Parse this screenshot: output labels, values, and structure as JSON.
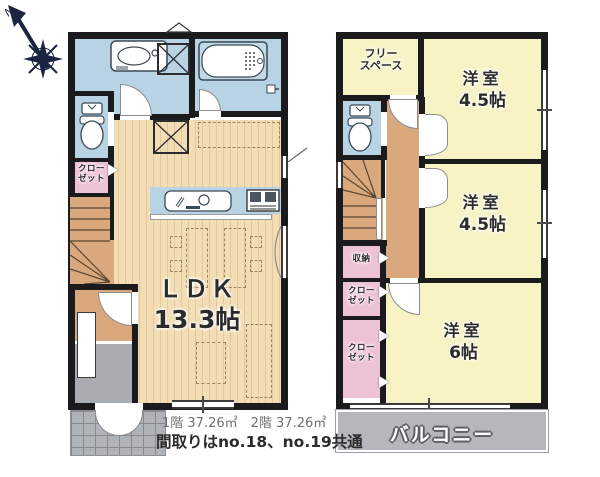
{
  "compass": {
    "north_label": "N"
  },
  "floor1": {
    "ldk": {
      "name": "ＬＤＫ",
      "size": "13.3帖"
    },
    "closet": {
      "line1": "クロー",
      "line2": "ゼット"
    }
  },
  "floor2": {
    "free_space": {
      "line1": "フリー",
      "line2": "スペース"
    },
    "room_45_a": {
      "name": "洋室",
      "size": "4.5帖"
    },
    "room_45_b": {
      "name": "洋室",
      "size": "4.5帖"
    },
    "room_6": {
      "name": "洋室",
      "size": "6帖"
    },
    "storage": {
      "label": "収納"
    },
    "closet_a": {
      "line1": "クロー",
      "line2": "ゼット"
    },
    "closet_b": {
      "line1": "クロー",
      "line2": "ゼット"
    },
    "balcony": {
      "label": "バルコニー"
    }
  },
  "footer": {
    "areas": "1階 37.26㎡　2階 37.26㎡",
    "note": "間取りはno.18、no.19共通"
  },
  "icons": {
    "compass": "compass-north-icon",
    "toilet": "toilet-icon",
    "bathtub": "bathtub-icon",
    "washbasin": "washbasin-icon",
    "kitchen_sink": "kitchen-sink-icon",
    "stove": "stove-icon",
    "washer_space": "washer-cross-box",
    "fridge_space": "fridge-cross-box"
  },
  "colors": {
    "wall": "#1b1b1d",
    "water_blue": "#b7d3e4",
    "room_yellow": "#f7f3c5",
    "wood_floor": "#f2ddb5",
    "hall_brown": "#d9a87d",
    "closet_pink": "#eec2d5",
    "balcony_gray": "#b4b7bb",
    "compass_navy": "#1b2440"
  }
}
